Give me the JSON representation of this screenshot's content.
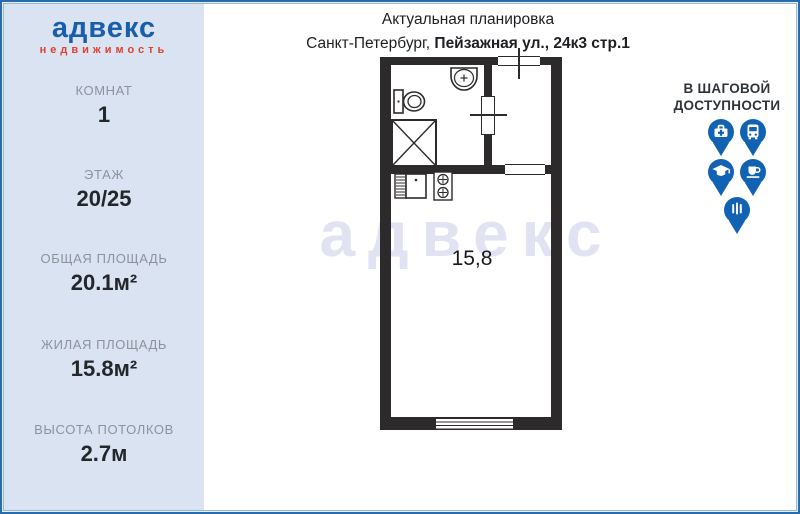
{
  "logo": {
    "wordmark": "адвекс",
    "subtitle": "недвижимость"
  },
  "header": {
    "title": "Актуальная планировка",
    "city_prefix": "Санкт-Петербург, ",
    "address_bold": "Пейзажная ул., 24к3 стр.1"
  },
  "sidebar": {
    "stats": [
      {
        "label": "КОМНАТ",
        "value": "1"
      },
      {
        "label": "ЭТАЖ",
        "value": "20/25"
      },
      {
        "label": "ОБЩАЯ ПЛОЩАДЬ",
        "value": "20.1м²"
      },
      {
        "label": "ЖИЛАЯ ПЛОЩАДЬ",
        "value": "15.8м²"
      },
      {
        "label": "ВЫСОТА ПОТОЛКОВ",
        "value": "2.7м"
      }
    ]
  },
  "walkability": {
    "title_line1": "В ШАГОВОЙ",
    "title_line2": "ДОСТУПНОСТИ",
    "pin_icons": [
      "medical-pin-icon",
      "transport-pin-icon",
      "education-pin-icon",
      "cafe-pin-icon",
      "restaurant-pin-icon"
    ]
  },
  "plan": {
    "room_area_label": "15,8",
    "watermark": "адвекс"
  },
  "colors": {
    "logo_blue": "#1a5dab",
    "logo_red": "#e2402f",
    "pin_blue": "#1262b3",
    "wall": "#2c2a2b",
    "sidebar_bg": "#d9e3f1",
    "watermark": "#e1e3f2"
  }
}
